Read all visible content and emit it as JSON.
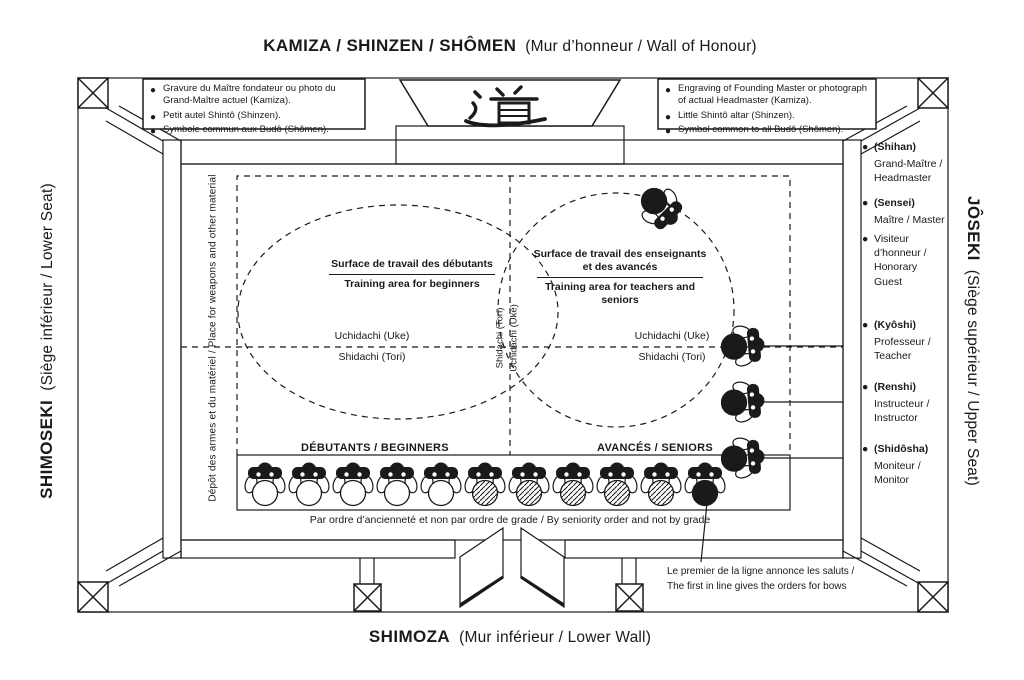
{
  "colors": {
    "ink": "#1a1a1a",
    "paper": "#ffffff"
  },
  "titles": {
    "top": {
      "main": "KAMIZA / SHINZEN / SHÔMEN",
      "sub": "(Mur d’honneur / Wall of Honour)"
    },
    "bottom": {
      "main": "SHIMOZA",
      "sub": "(Mur inférieur / Lower Wall)"
    },
    "left": {
      "main": "SHIMOSEKI",
      "sub": "(Siège inférieur / Lower Seat)"
    },
    "right": {
      "main": "JÔSEKI",
      "sub": "(Siège supérieur / Upper Seat)"
    }
  },
  "notes_fr": {
    "items": [
      "Gravure du Maître fondateur ou photo du Grand-Maître actuel (Kamiza).",
      "Petit autel Shintô (Shinzen).",
      "Symbole commun aux Budô (Shômen)."
    ]
  },
  "notes_en": {
    "items": [
      "Engraving of Founding Master or photograph of actual Headmaster (Kamiza).",
      "Little Shintô altar (Shinzen).",
      "Symbol common to all Budô (Shômen)."
    ]
  },
  "altar": {
    "kanji": "道"
  },
  "panel": {
    "items": [
      {
        "term": "(Shihan)",
        "desc": "Grand-Maître / Headmaster"
      },
      {
        "term": "(Sensei)",
        "desc": "Maître / Master"
      },
      {
        "term": "Visiteur d’honneur /",
        "desc": "Honorary Guest"
      },
      {
        "term": "(Kyôshi)",
        "desc": "Professeur / Teacher"
      },
      {
        "term": "(Renshi)",
        "desc": "Instructeur / Instructor"
      },
      {
        "term": "(Shidôsha)",
        "desc": "Moniteur / Monitor"
      }
    ]
  },
  "areas": {
    "left_fr": "Surface de travail des débutants",
    "left_en": "Training area for beginners",
    "right_fr": "Surface de travail des enseignants et des avancés",
    "right_en": "Training area for teachers and seniors"
  },
  "partners": {
    "uke": "Uchidachi (Uke)",
    "tori": "Shidachi (Tori)"
  },
  "axis": {
    "left": "Shidachi (Tori)",
    "right": "Uchidachi (Uke)"
  },
  "weapons": {
    "note": "Dépôt des armes et du matériel / Place for weapons and other material"
  },
  "rows": {
    "beginners": "DÉBUTANTS / BEGINNERS",
    "seniors": "AVANCÉS / SENIORS"
  },
  "seniority": {
    "note": "Par ordre d’ancienneté et non par ordre de grade / By seniority order and not by grade"
  },
  "first_in_line": {
    "fr": "Le premier de la ligne annonce les saluts /",
    "en": "The first in line gives the orders for bows"
  },
  "figures": {
    "bottom_row": [
      "white",
      "white",
      "white",
      "white",
      "white",
      "hatch",
      "hatch",
      "hatch",
      "hatch",
      "hatch",
      "black"
    ],
    "right_column_count": 3,
    "kamiza_count": 1
  }
}
